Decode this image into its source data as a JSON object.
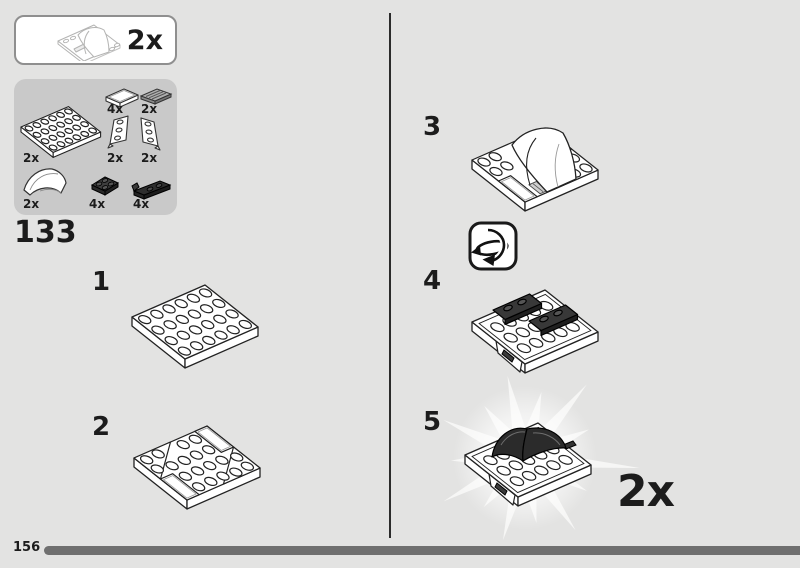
{
  "page": {
    "number": "156"
  },
  "step_group": {
    "number": "133"
  },
  "callout": {
    "quantity": "2x"
  },
  "parts_box": {
    "parts": [
      {
        "part": "tile-1x2-white",
        "qty": "4x"
      },
      {
        "part": "grille-tile-1x2-gray",
        "qty": "2x"
      },
      {
        "part": "plate-4x6-white",
        "qty": "2x"
      },
      {
        "part": "wedge-plate-left-white",
        "qty": "2x"
      },
      {
        "part": "wedge-plate-right-white",
        "qty": "2x"
      },
      {
        "part": "curved-slope-white",
        "qty": "2x"
      },
      {
        "part": "plate-2x2-dark-gray",
        "qty": "4x"
      },
      {
        "part": "plate-1x2-rail-black",
        "qty": "4x"
      }
    ]
  },
  "steps": [
    {
      "number": "1"
    },
    {
      "number": "2"
    },
    {
      "number": "3"
    },
    {
      "number": "4",
      "icon": "rotate-model-icon"
    },
    {
      "number": "5",
      "quantity": "2x"
    }
  ],
  "colors": {
    "page_bg": "#e3e3e2",
    "parts_box_bg": "#c9c9c9",
    "progress_bar": "#6f6f6f",
    "ink": "#1c1c1c"
  }
}
